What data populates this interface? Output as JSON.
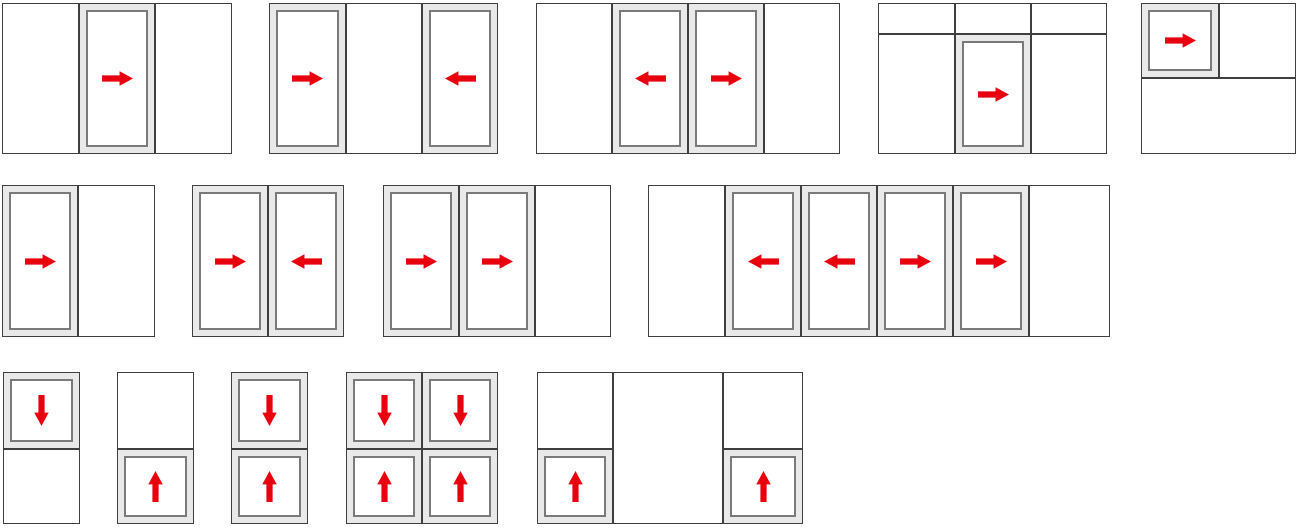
{
  "canvas": {
    "width": 1300,
    "height": 528
  },
  "colors": {
    "frame_border": "#2e2e2e",
    "divider": "#3f3f3f",
    "sash_fill": "#e9e9e9",
    "sash_border": "#7a7a7a",
    "cell_fill": "#ffffff",
    "arrow": "#e8000f",
    "canvas_bg": "#ffffff"
  },
  "arrow_icon": {
    "viewbox": "0 0 30 16",
    "path": "M0 5 L17 5 L17 1 L30 8 L17 15 L17 11 L0 11 Z"
  },
  "diagrams": [
    {
      "id": "config-01",
      "x": 2,
      "y": 3,
      "w": 230,
      "h": 151,
      "cells": [
        {
          "x": 0,
          "y": 0,
          "w": 77,
          "h": 151,
          "type": "fixed"
        },
        {
          "x": 77,
          "y": 0,
          "w": 76,
          "h": 151,
          "type": "sash",
          "arrow": "right"
        },
        {
          "x": 153,
          "y": 0,
          "w": 77,
          "h": 151,
          "type": "fixed"
        }
      ]
    },
    {
      "id": "config-02",
      "x": 269,
      "y": 3,
      "w": 229,
      "h": 151,
      "cells": [
        {
          "x": 0,
          "y": 0,
          "w": 77,
          "h": 151,
          "type": "sash",
          "arrow": "right"
        },
        {
          "x": 77,
          "y": 0,
          "w": 76,
          "h": 151,
          "type": "fixed"
        },
        {
          "x": 153,
          "y": 0,
          "w": 76,
          "h": 151,
          "type": "sash",
          "arrow": "left"
        }
      ]
    },
    {
      "id": "config-03",
      "x": 536,
      "y": 3,
      "w": 304,
      "h": 151,
      "cells": [
        {
          "x": 0,
          "y": 0,
          "w": 76,
          "h": 151,
          "type": "fixed"
        },
        {
          "x": 76,
          "y": 0,
          "w": 76,
          "h": 151,
          "type": "sash",
          "arrow": "left"
        },
        {
          "x": 152,
          "y": 0,
          "w": 76,
          "h": 151,
          "type": "sash",
          "arrow": "right"
        },
        {
          "x": 228,
          "y": 0,
          "w": 76,
          "h": 151,
          "type": "fixed"
        }
      ]
    },
    {
      "id": "config-04",
      "x": 878,
      "y": 3,
      "w": 229,
      "h": 151,
      "cells": [
        {
          "x": 0,
          "y": 0,
          "w": 77,
          "h": 31,
          "type": "fixed"
        },
        {
          "x": 77,
          "y": 0,
          "w": 76,
          "h": 31,
          "type": "fixed"
        },
        {
          "x": 153,
          "y": 0,
          "w": 76,
          "h": 31,
          "type": "fixed"
        },
        {
          "x": 0,
          "y": 31,
          "w": 77,
          "h": 120,
          "type": "fixed"
        },
        {
          "x": 77,
          "y": 31,
          "w": 76,
          "h": 120,
          "type": "sash",
          "arrow": "right"
        },
        {
          "x": 153,
          "y": 31,
          "w": 76,
          "h": 120,
          "type": "fixed"
        }
      ]
    },
    {
      "id": "config-05",
      "x": 1141,
      "y": 3,
      "w": 155,
      "h": 151,
      "cells": [
        {
          "x": 0,
          "y": 0,
          "w": 78,
          "h": 75,
          "type": "sash",
          "arrow": "right"
        },
        {
          "x": 78,
          "y": 0,
          "w": 77,
          "h": 75,
          "type": "fixed"
        },
        {
          "x": 0,
          "y": 75,
          "w": 155,
          "h": 76,
          "type": "fixed"
        }
      ]
    },
    {
      "id": "config-06",
      "x": 2,
      "y": 185,
      "w": 153,
      "h": 152,
      "cells": [
        {
          "x": 0,
          "y": 0,
          "w": 76,
          "h": 152,
          "type": "sash",
          "arrow": "right"
        },
        {
          "x": 76,
          "y": 0,
          "w": 77,
          "h": 152,
          "type": "fixed"
        }
      ]
    },
    {
      "id": "config-07",
      "x": 192,
      "y": 185,
      "w": 152,
      "h": 152,
      "cells": [
        {
          "x": 0,
          "y": 0,
          "w": 76,
          "h": 152,
          "type": "sash",
          "arrow": "right"
        },
        {
          "x": 76,
          "y": 0,
          "w": 76,
          "h": 152,
          "type": "sash",
          "arrow": "left"
        }
      ]
    },
    {
      "id": "config-08",
      "x": 383,
      "y": 185,
      "w": 228,
      "h": 152,
      "cells": [
        {
          "x": 0,
          "y": 0,
          "w": 76,
          "h": 152,
          "type": "sash",
          "arrow": "right"
        },
        {
          "x": 76,
          "y": 0,
          "w": 76,
          "h": 152,
          "type": "sash",
          "arrow": "right"
        },
        {
          "x": 152,
          "y": 0,
          "w": 76,
          "h": 152,
          "type": "fixed"
        }
      ]
    },
    {
      "id": "config-09",
      "x": 648,
      "y": 185,
      "w": 462,
      "h": 152,
      "cells": [
        {
          "x": 0,
          "y": 0,
          "w": 77,
          "h": 152,
          "type": "fixed"
        },
        {
          "x": 77,
          "y": 0,
          "w": 76,
          "h": 152,
          "type": "sash",
          "arrow": "left"
        },
        {
          "x": 153,
          "y": 0,
          "w": 76,
          "h": 152,
          "type": "sash",
          "arrow": "left"
        },
        {
          "x": 229,
          "y": 0,
          "w": 76,
          "h": 152,
          "type": "sash",
          "arrow": "right"
        },
        {
          "x": 305,
          "y": 0,
          "w": 76,
          "h": 152,
          "type": "sash",
          "arrow": "right"
        },
        {
          "x": 381,
          "y": 0,
          "w": 81,
          "h": 152,
          "type": "fixed"
        }
      ]
    },
    {
      "id": "config-10",
      "x": 3,
      "y": 372,
      "w": 77,
      "h": 152,
      "cells": [
        {
          "x": 0,
          "y": 0,
          "w": 77,
          "h": 77,
          "type": "sash",
          "arrow": "down"
        },
        {
          "x": 0,
          "y": 77,
          "w": 77,
          "h": 75,
          "type": "fixed"
        }
      ]
    },
    {
      "id": "config-11",
      "x": 117,
      "y": 372,
      "w": 77,
      "h": 152,
      "cells": [
        {
          "x": 0,
          "y": 0,
          "w": 77,
          "h": 77,
          "type": "fixed"
        },
        {
          "x": 0,
          "y": 77,
          "w": 77,
          "h": 75,
          "type": "sash",
          "arrow": "up"
        }
      ]
    },
    {
      "id": "config-12",
      "x": 231,
      "y": 372,
      "w": 77,
      "h": 152,
      "cells": [
        {
          "x": 0,
          "y": 0,
          "w": 77,
          "h": 77,
          "type": "sash",
          "arrow": "down"
        },
        {
          "x": 0,
          "y": 77,
          "w": 77,
          "h": 75,
          "type": "sash",
          "arrow": "up"
        }
      ]
    },
    {
      "id": "config-13",
      "x": 346,
      "y": 372,
      "w": 152,
      "h": 152,
      "cells": [
        {
          "x": 0,
          "y": 0,
          "w": 76,
          "h": 77,
          "type": "sash",
          "arrow": "down"
        },
        {
          "x": 76,
          "y": 0,
          "w": 76,
          "h": 77,
          "type": "sash",
          "arrow": "down"
        },
        {
          "x": 0,
          "y": 77,
          "w": 76,
          "h": 75,
          "type": "sash",
          "arrow": "up"
        },
        {
          "x": 76,
          "y": 77,
          "w": 76,
          "h": 75,
          "type": "sash",
          "arrow": "up"
        }
      ]
    },
    {
      "id": "config-14",
      "x": 537,
      "y": 372,
      "w": 266,
      "h": 152,
      "cells": [
        {
          "x": 0,
          "y": 0,
          "w": 76,
          "h": 77,
          "type": "fixed"
        },
        {
          "x": 0,
          "y": 77,
          "w": 76,
          "h": 75,
          "type": "sash",
          "arrow": "up"
        },
        {
          "x": 76,
          "y": 0,
          "w": 110,
          "h": 152,
          "type": "fixed"
        },
        {
          "x": 186,
          "y": 0,
          "w": 80,
          "h": 77,
          "type": "fixed"
        },
        {
          "x": 186,
          "y": 77,
          "w": 80,
          "h": 75,
          "type": "sash",
          "arrow": "up"
        }
      ]
    }
  ]
}
